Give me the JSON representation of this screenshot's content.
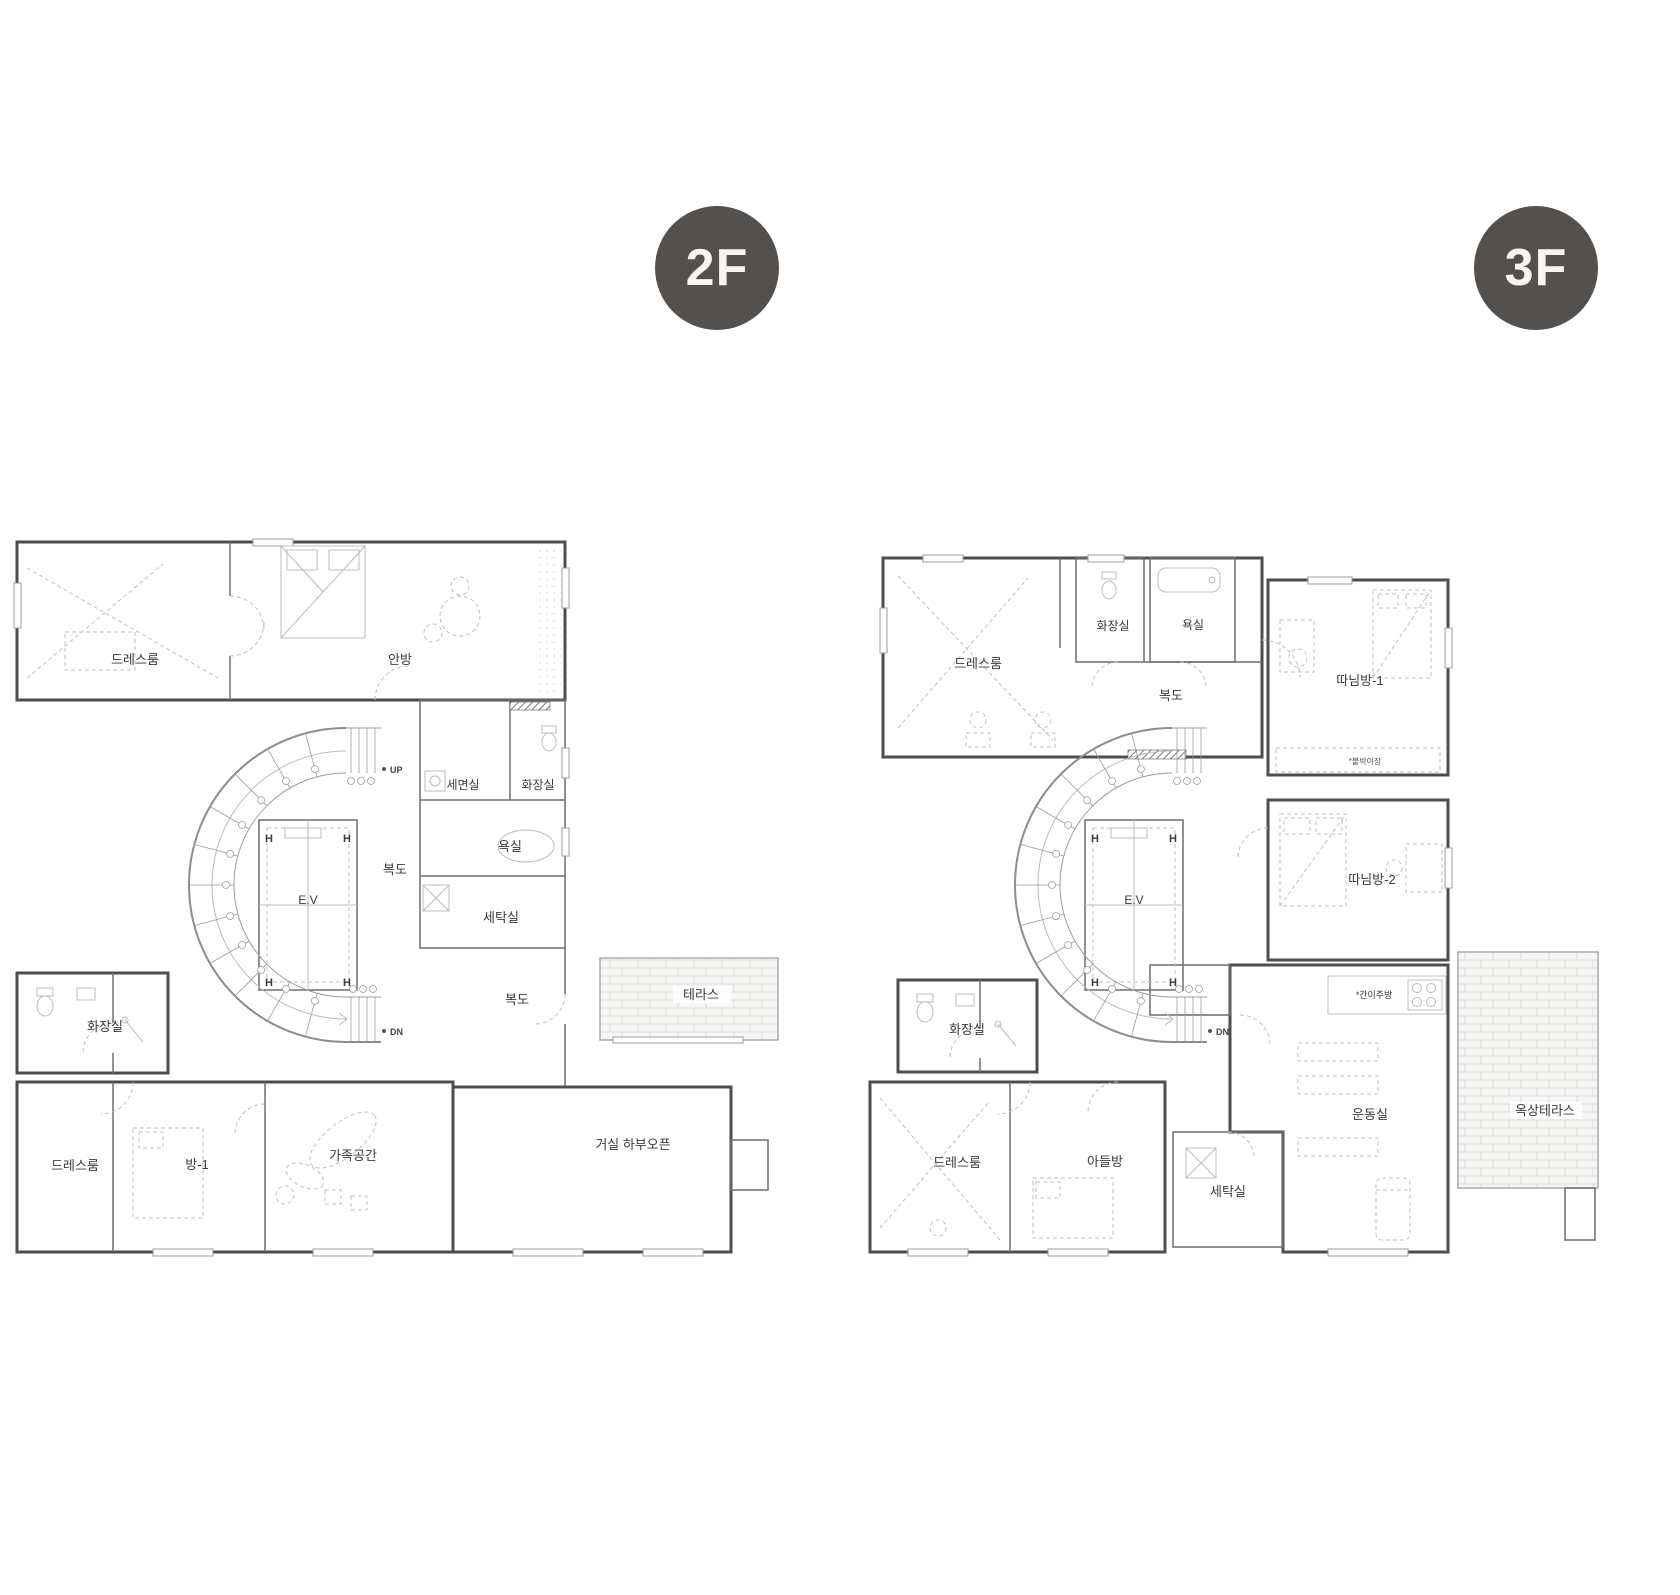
{
  "colors": {
    "badge_bg": "#54504d",
    "badge_text": "#f7f5f2",
    "wall": "#4d4d4d",
    "detail": "#bcbcbc"
  },
  "plan_2f": {
    "badge": "2F",
    "labels": {
      "dressroom_upper": "드레스룸",
      "master_bedroom": "안방",
      "up": "UP",
      "washroom": "세면실",
      "toilet_upper": "화장실",
      "bathroom": "욕실",
      "corridor_mid": "복도",
      "elevator": "E.V",
      "laundry": "세탁실",
      "corridor_lower": "복도",
      "terrace": "테라스",
      "dn": "DN",
      "toilet_lower": "화장실",
      "dressroom_lower": "드레스룸",
      "room1": "방-1",
      "family_space": "가족공간",
      "living_open": "거실 하부오픈",
      "ev_corner_mark": "H"
    }
  },
  "plan_3f": {
    "badge": "3F",
    "labels": {
      "dressroom_upper": "드레스룸",
      "toilet_upper": "화장실",
      "bathroom": "욕실",
      "corridor": "복도",
      "daughter_room1": "따님방-1",
      "builtin_closet_note": "*붙박이장",
      "daughter_room2": "따님방-2",
      "elevator": "E.V",
      "dn": "DN",
      "kitchenette_note": "*간이주방",
      "toilet_lower": "화장실",
      "dressroom_lower": "드레스룸",
      "son_room": "아들방",
      "laundry": "세탁실",
      "exercise_room": "운동실",
      "roof_terrace": "옥상테라스",
      "ev_corner_mark": "H"
    }
  }
}
